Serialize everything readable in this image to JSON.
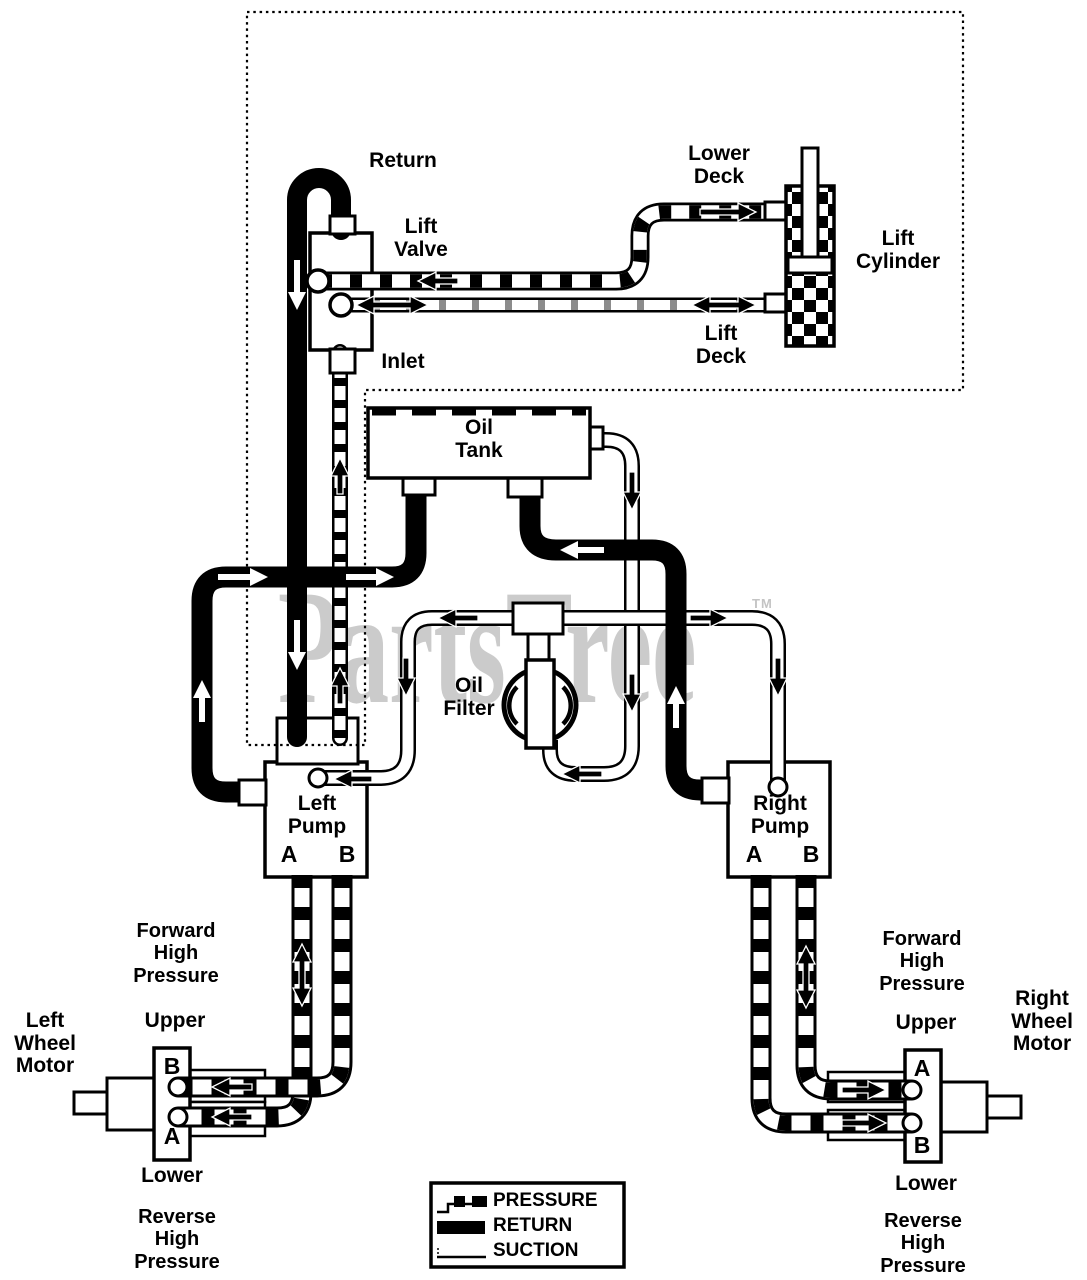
{
  "page": {
    "background_color": "#ffffff",
    "ink_color": "#000000",
    "watermark_color": "#cbcbcb"
  },
  "watermark": {
    "text": "PartsTree",
    "tm": "TM"
  },
  "labels": {
    "return": "Return",
    "lift_valve": "Lift\nValve",
    "inlet": "Inlet",
    "lower_deck": "Lower\nDeck",
    "lift_deck": "Lift\nDeck",
    "lift_cylinder": "Lift\nCylinder",
    "oil_tank": "Oil\nTank",
    "oil_filter": "Oil\nFilter",
    "left_pump": "Left\nPump",
    "right_pump": "Right\nPump",
    "port_a": "A",
    "port_b": "B",
    "forward_high_pressure": "Forward\nHigh\nPressure",
    "reverse_high_pressure": "Reverse\nHigh\nPressure",
    "upper": "Upper",
    "lower": "Lower",
    "left_wheel_motor": "Left\nWheel\nMotor",
    "right_wheel_motor": "Right\nWheel\nMotor"
  },
  "legend": {
    "items": [
      {
        "id": "pressure",
        "label": "PRESSURE"
      },
      {
        "id": "return",
        "label": "RETURN"
      },
      {
        "id": "suction",
        "label": "SUCTION"
      }
    ]
  }
}
